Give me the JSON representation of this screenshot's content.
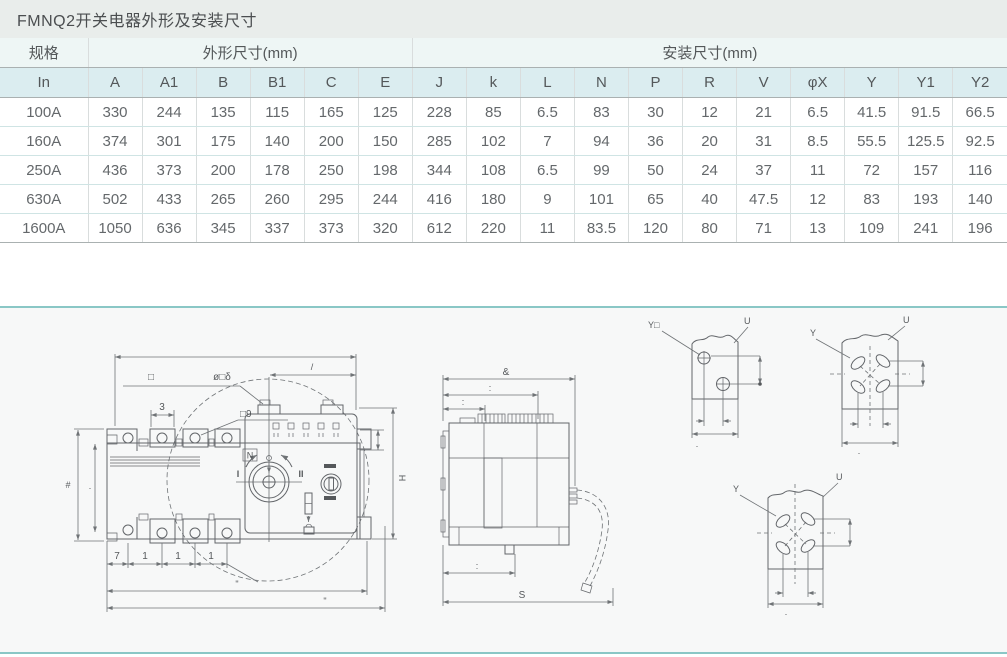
{
  "title": "FMNQ2开关电器外形及安装尺寸",
  "table": {
    "spec_header": "规格",
    "group_headers": [
      {
        "label": "外形尺寸(mm)",
        "span": 6
      },
      {
        "label": "安装尺寸(mm)",
        "span": 11
      }
    ],
    "columns": [
      "In",
      "A",
      "A1",
      "B",
      "B1",
      "C",
      "E",
      "J",
      "k",
      "L",
      "N",
      "P",
      "R",
      "V",
      "φX",
      "Y",
      "Y1",
      "Y2"
    ],
    "rows": [
      [
        "100A",
        "330",
        "244",
        "135",
        "115",
        "165",
        "125",
        "228",
        "85",
        "6.5",
        "83",
        "30",
        "12",
        "21",
        "6.5",
        "41.5",
        "91.5",
        "66.5"
      ],
      [
        "160A",
        "374",
        "301",
        "175",
        "140",
        "200",
        "150",
        "285",
        "102",
        "7",
        "94",
        "36",
        "20",
        "31",
        "8.5",
        "55.5",
        "125.5",
        "92.5"
      ],
      [
        "250A",
        "436",
        "373",
        "200",
        "178",
        "250",
        "198",
        "344",
        "108",
        "6.5",
        "99",
        "50",
        "24",
        "37",
        "11",
        "72",
        "157",
        "116"
      ],
      [
        "630A",
        "502",
        "433",
        "265",
        "260",
        "295",
        "244",
        "416",
        "180",
        "9",
        "101",
        "65",
        "40",
        "47.5",
        "12",
        "83",
        "193",
        "140"
      ],
      [
        "1600A",
        "1050",
        "636",
        "345",
        "337",
        "373",
        "320",
        "612",
        "220",
        "11",
        "83.5",
        "120",
        "80",
        "71",
        "13",
        "109",
        "241",
        "196"
      ]
    ]
  },
  "colors": {
    "panel_border": "#8ac7c6",
    "title_bg": "#e9edeb",
    "header_bg": "#dbedf0",
    "line": "#63666a"
  },
  "diagram": {
    "front": {
      "square_note": "□",
      "phi_note": "ø□δ",
      "dim_3": "3",
      "square9_note": "□9",
      "neutral": "N",
      "pos_i": "I",
      "pos_ii": "II",
      "height_label": "#",
      "inner_height_label": "·",
      "right_height_label": "H",
      "top_right_label": "/",
      "pitch_labels": [
        "7",
        "1",
        "1",
        "1"
      ],
      "width_inner_label": "\"",
      "width_outer_label": "\""
    },
    "side": {
      "top_label": "&",
      "mid_label": ":",
      "small_label": ":",
      "bottom_small_label": ":",
      "bottom_label": "S"
    },
    "plates": [
      {
        "hole_label": "Y□",
        "plate_label": "U",
        "dim_label": "·"
      },
      {
        "hole_label": "Y",
        "plate_label": "U",
        "dim_label": "·"
      },
      {
        "hole_label": "Y",
        "plate_label": "U",
        "dim_label": "·"
      }
    ]
  }
}
